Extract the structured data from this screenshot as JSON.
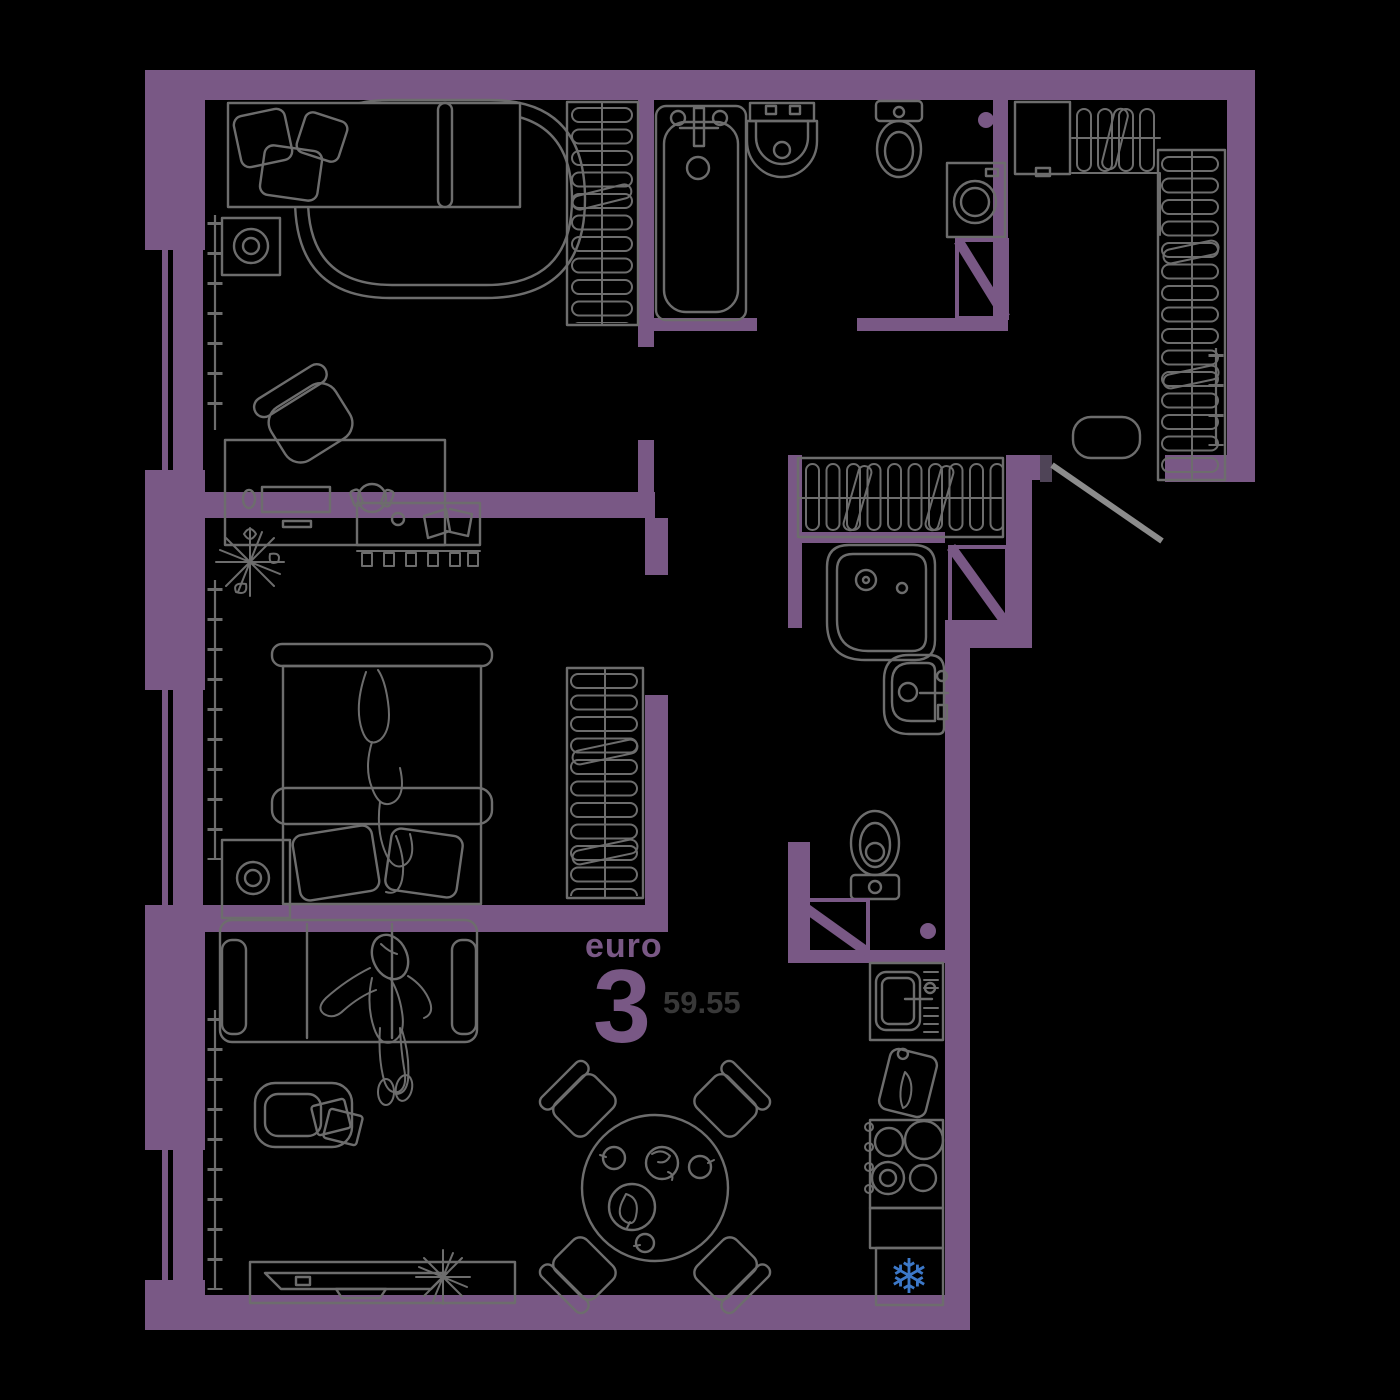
{
  "floorplan": {
    "label": {
      "type_prefix": "euro",
      "rooms_count": "3",
      "area": "59.55"
    },
    "icons": {
      "snowflake": "❄"
    },
    "colors": {
      "background": "#000000",
      "wall": "#795885",
      "furniture_line": "#6d6d6d",
      "door_leaf": "#8c8c8c",
      "jamb": "#4f4457",
      "area_text": "#383838",
      "snowflake": "#3c78c8"
    }
  }
}
